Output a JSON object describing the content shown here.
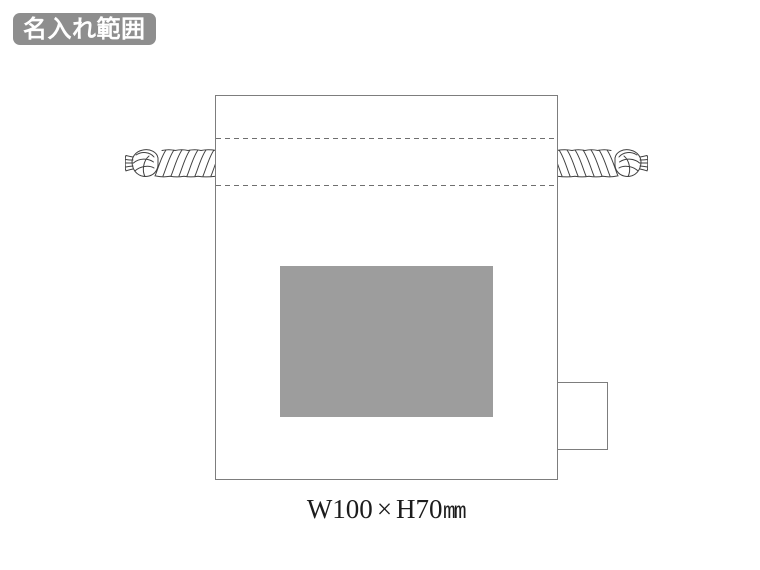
{
  "badge": {
    "label": "名入れ範囲",
    "background_color": "#8e8e8e",
    "text_color": "#ffffff"
  },
  "diagram": {
    "subject": "drawstring-pouch-front-view",
    "outline_color": "#7d7d7d",
    "dashed_channel_color": "#6f6f6f",
    "print_area": {
      "fill_color": "#9d9d9d",
      "width_mm": 100,
      "height_mm": 70
    },
    "size_caption": {
      "w": "W100",
      "sep": "×",
      "h": "H70",
      "unit": "mm"
    }
  },
  "icons": {
    "rope_left": "twisted-drawstring-cord-knot-left",
    "rope_right": "twisted-drawstring-cord-knot-right"
  }
}
